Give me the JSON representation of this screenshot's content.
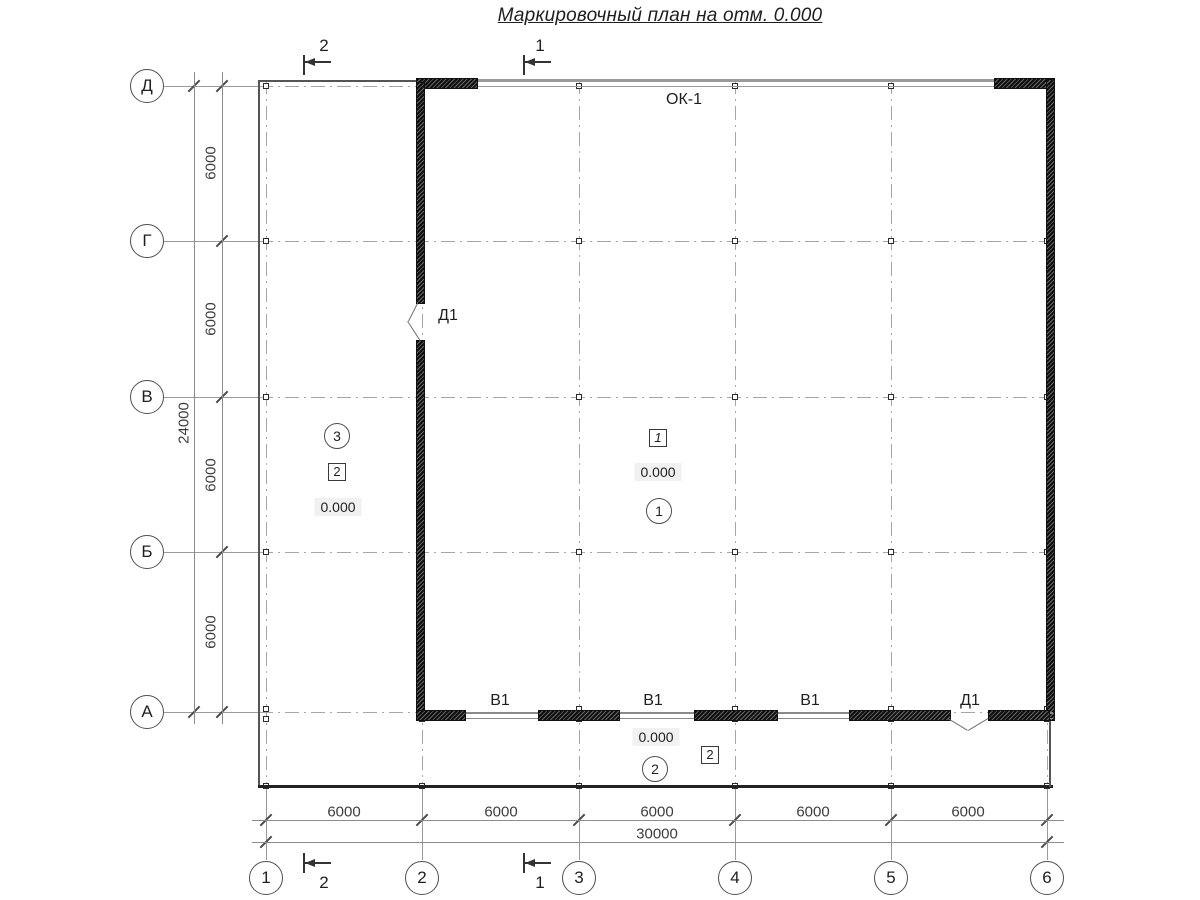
{
  "title": "Маркировочный план на отм. 0.000",
  "axis_rows": [
    {
      "label": "Д"
    },
    {
      "label": "Г"
    },
    {
      "label": "В"
    },
    {
      "label": "Б"
    },
    {
      "label": "А"
    }
  ],
  "axis_cols": [
    {
      "label": "1"
    },
    {
      "label": "2"
    },
    {
      "label": "3"
    },
    {
      "label": "4"
    },
    {
      "label": "5"
    },
    {
      "label": "6"
    }
  ],
  "dims": {
    "left": [
      "6000",
      "6000",
      "6000",
      "6000"
    ],
    "left_total": "24000",
    "bottom": [
      "6000",
      "6000",
      "6000",
      "6000",
      "6000"
    ],
    "bottom_total": "30000"
  },
  "marks": {
    "window": "ОК-1",
    "gates": [
      "В1",
      "В1",
      "В1"
    ],
    "door_axis2": "Д1",
    "door_axisA": "Д1"
  },
  "rooms": {
    "hall": {
      "box": "1",
      "elevation": "0.000",
      "circle": "1"
    },
    "annex_left": {
      "circle": "3",
      "box": "2",
      "elevation": "0.000"
    },
    "annex_bottom": {
      "elevation": "0.000",
      "box": "2",
      "circle": "2"
    }
  },
  "cuts": {
    "one": "1",
    "two": "2"
  }
}
